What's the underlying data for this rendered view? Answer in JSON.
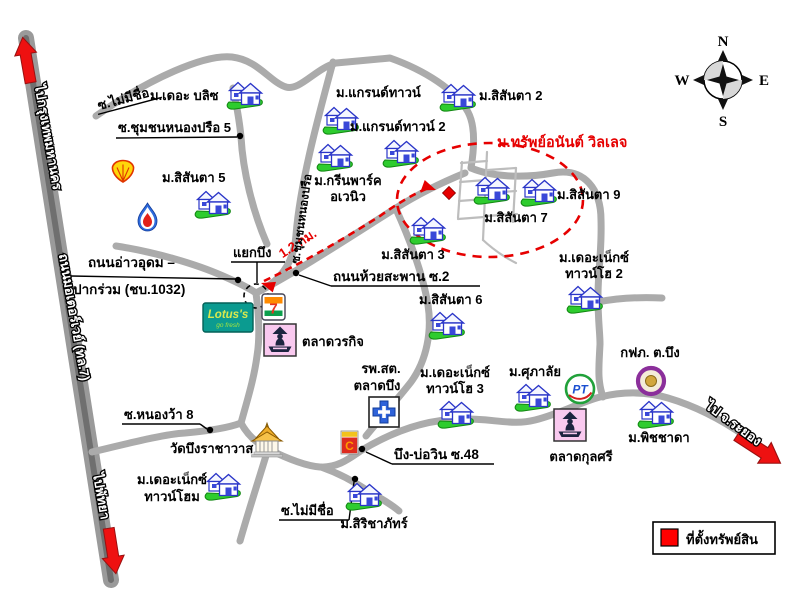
{
  "roads": {
    "to_bangkok": "ไปกรุงเทพมหานคร",
    "motorway": "ถนนมอเตอร์เวย์ (ทล.7)",
    "to_pattaya": "ไปพัทยา",
    "to_rayong": "ไป จ.ระยอง",
    "soi_no_name_top": "ซ.ไม่มีชื่อ",
    "soi_no_name_bottom": "ซ.ไม่มีชื่อ",
    "soi_chumchon_nongprue_5": "ซ.ชุมชนหนองปรือ 5",
    "soi_chumchon_nongprue": "ซ.ชุมชนหนองปรือ",
    "ao_udom_line1": "ถนนอ่าวอุดม –",
    "ao_udom_line2": "ปากร่วม (ชบ.1032)",
    "yaek_bueng": "แยกบึง",
    "huai_saphan": "ถนนห้วยสะพาน ซ.2",
    "soi_nongwa_8": "ซ.หนองว้า 8",
    "bueng_bowin": "บึง-บ่อวิน ซ.48"
  },
  "highlight": {
    "label": "ม.ทรัพย์อนันต์ วิลเลจ",
    "distance": "1.2 กม.",
    "color": "#e60000"
  },
  "villages": {
    "the_blitz": "ม.เดอะ บลิซ",
    "sisanta_5": "ม.สิสันตา 5",
    "grand_town": "ม.แกรนด์ทาวน์",
    "grand_town_2": "ม.แกรนด์ทาวน์ 2",
    "sisanta_2": "ม.สิสันตา 2",
    "green_park_line1": "ม.กรีนพาร์ค",
    "green_park_line2": "อเวนิว",
    "sisanta_3": "ม.สิสันตา 3",
    "sisanta_6": "ม.สิสันตา 6",
    "sisanta_7": "ม.สิสันตา 7",
    "sisanta_9": "ม.สิสันตา 9",
    "the_next_town_2_line1": "ม.เดอะเน็กซ์",
    "the_next_town_2_line2": "ทาวน์โฮ 2",
    "the_next_town_3_line1": "ม.เดอะเน็กซ์",
    "the_next_town_3_line2": "ทาวน์โฮ 3",
    "the_next_townhome_line1": "ม.เดอะเน็กซ์",
    "the_next_townhome_line2": "ทาวน์โฮม",
    "supalai": "ม.ศุภาลัย",
    "sirichapat": "ม.สิริชาภัทร์",
    "pitchada": "ม.พิชชาดา"
  },
  "landmarks": {
    "wat": "วัดบึงราชาวาส",
    "market_worakit": "ตลาดวรกิจ",
    "market_kulsri": "ตลาดกุลศรี",
    "hospital_line1": "รพ.สต.",
    "hospital_line2": "ตลาดบึง",
    "pea": "กฟภ. ต.บึง"
  },
  "brands": {
    "lotus": "Lotus's",
    "lotus_sub": "go fresh",
    "seven": "7",
    "pt": "PT",
    "minimart": "C"
  },
  "legend": {
    "label": "ที่ตั้งทรัพย์สิน"
  },
  "compass": {
    "n": "N",
    "e": "E",
    "s": "S",
    "w": "W"
  }
}
